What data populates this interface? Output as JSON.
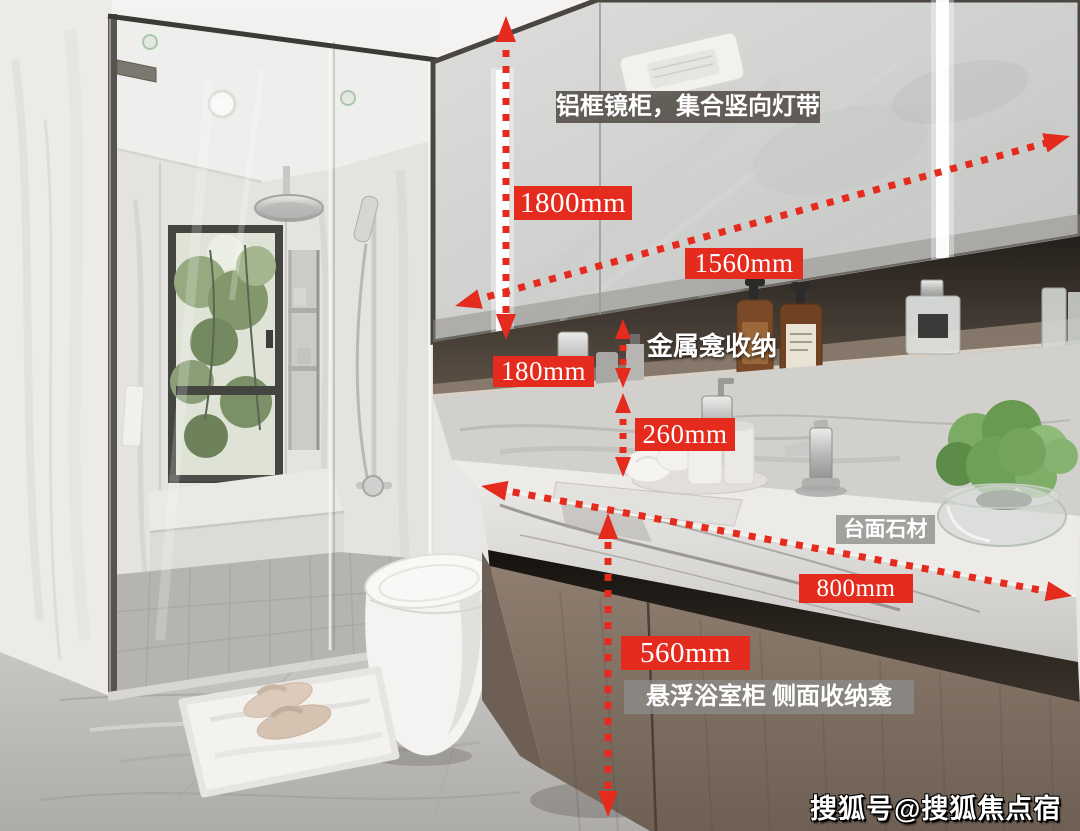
{
  "page": {
    "type": "annotated-bathroom-interior-photo"
  },
  "colors": {
    "annotation-red": "#e52a1e",
    "note-dark-bg": "rgba(72,66,60,0.82)",
    "note-gray-bg": "rgba(140,140,137,0.78)",
    "label-text": "#ffffff"
  },
  "dimensions": {
    "mirror_height": "1800mm",
    "mirror_width": "1560mm",
    "niche_height": "180mm",
    "backsplash_height": "260mm",
    "counter_depth": "800mm",
    "cabinet_height": "560mm"
  },
  "notes": {
    "mirror_cabinet": "铝框镜柜，集合竖向灯带",
    "metal_niche": "金属龛收纳",
    "countertop": "台面石材",
    "vanity_cabinet": "悬浮浴室柜 侧面收纳龛"
  },
  "watermark": "搜狐号@搜狐焦点宿州站"
}
